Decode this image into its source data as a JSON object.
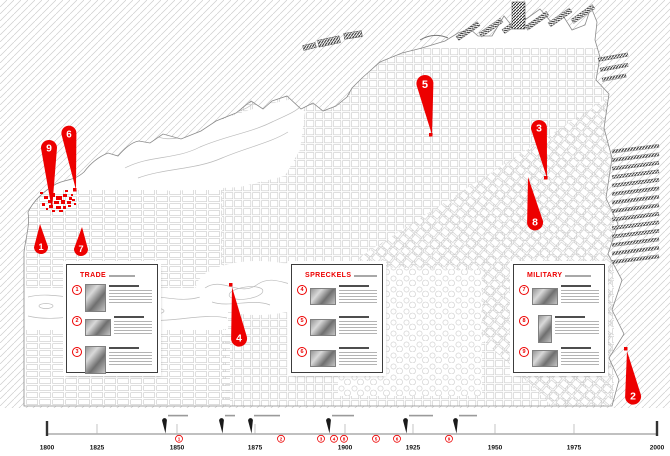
{
  "accent_red": "#ed0000",
  "map": {
    "pins": [
      {
        "number": "1",
        "bulb": [
          41,
          247
        ],
        "tip": [
          40,
          224
        ],
        "r": 7
      },
      {
        "number": "2",
        "bulb": [
          633,
          396
        ],
        "tip": [
          627,
          351
        ],
        "r": 8
      },
      {
        "number": "3",
        "bulb": [
          539,
          128
        ],
        "tip": [
          547,
          178
        ],
        "r": 8
      },
      {
        "number": "4",
        "bulb": [
          239,
          338
        ],
        "tip": [
          232,
          287
        ],
        "r": 8
      },
      {
        "number": "5",
        "bulb": [
          425,
          84
        ],
        "tip": [
          432,
          135
        ],
        "r": 8.5
      },
      {
        "number": "6",
        "bulb": [
          69,
          134
        ],
        "tip": [
          76,
          190
        ],
        "r": 7.5
      },
      {
        "number": "7",
        "bulb": [
          81,
          249
        ],
        "tip": [
          82,
          227
        ],
        "r": 7
      },
      {
        "number": "8",
        "bulb": [
          535,
          222
        ],
        "tip": [
          528,
          177
        ],
        "r": 8
      },
      {
        "number": "9",
        "bulb": [
          49,
          148
        ],
        "tip": [
          52,
          210
        ],
        "r": 8
      }
    ],
    "highlight_cluster": {
      "color": "#ed0000",
      "dots": [
        [
          44,
          196,
          4,
          3
        ],
        [
          50,
          193,
          5,
          4
        ],
        [
          56,
          196,
          6,
          4
        ],
        [
          63,
          194,
          4,
          3
        ],
        [
          69,
          197,
          3,
          3
        ],
        [
          48,
          200,
          4,
          3
        ],
        [
          54,
          201,
          5,
          3
        ],
        [
          61,
          200,
          4,
          4
        ],
        [
          67,
          201,
          4,
          3
        ],
        [
          72,
          199,
          3,
          2
        ],
        [
          42,
          203,
          3,
          3
        ],
        [
          49,
          205,
          4,
          3
        ],
        [
          56,
          206,
          5,
          3
        ],
        [
          63,
          206,
          3,
          3
        ],
        [
          68,
          205,
          3,
          2
        ],
        [
          52,
          210,
          3,
          2
        ],
        [
          59,
          210,
          4,
          2
        ],
        [
          40,
          192,
          3,
          2
        ],
        [
          74,
          203,
          2,
          2
        ],
        [
          65,
          190,
          3,
          2
        ],
        [
          71,
          194,
          2,
          2
        ],
        [
          46,
          208,
          2,
          2
        ]
      ]
    },
    "tip_marks": [
      [
        429,
        133
      ],
      [
        544,
        176
      ],
      [
        229,
        283
      ],
      [
        624,
        347
      ],
      [
        73,
        188
      ]
    ]
  },
  "panels": [
    {
      "title": "TRADE",
      "entries": [
        {
          "number": "1"
        },
        {
          "number": "2"
        },
        {
          "number": "3"
        }
      ]
    },
    {
      "title": "SPRECKELS",
      "entries": [
        {
          "number": "4"
        },
        {
          "number": "5"
        },
        {
          "number": "6"
        }
      ]
    },
    {
      "title": "MILITARY",
      "entries": [
        {
          "number": "7"
        },
        {
          "number": "8"
        },
        {
          "number": "9"
        }
      ]
    }
  ],
  "timeline": {
    "years": [
      "1800",
      "1825",
      "1850",
      "1875",
      "1900",
      "1925",
      "1950",
      "1975",
      "2000"
    ],
    "events": [
      {
        "x": 165
      },
      {
        "x": 222
      },
      {
        "x": 251
      },
      {
        "x": 329
      },
      {
        "x": 406
      },
      {
        "x": 456
      }
    ],
    "badges": [
      {
        "number": "1",
        "x": 179
      },
      {
        "number": "2",
        "x": 281
      },
      {
        "number": "3",
        "x": 321
      },
      {
        "number": "4",
        "x": 334
      },
      {
        "number": "8",
        "x": 344
      },
      {
        "number": "5",
        "x": 376
      },
      {
        "number": "6",
        "x": 397
      },
      {
        "number": "9",
        "x": 449
      }
    ]
  }
}
